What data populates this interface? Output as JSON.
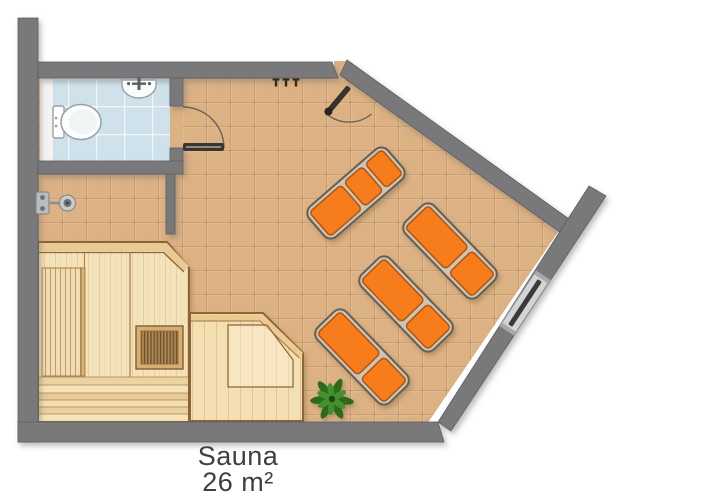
{
  "label": {
    "name": "Sauna",
    "area": "26 m²"
  },
  "palette": {
    "background": "#ffffff",
    "wall_gray": "#79797b",
    "floor_tile": "#dcb183",
    "bathroom_tile": "#cfe2ec",
    "wood_light": "#f2dfb5",
    "wood_frame": "#8d6537",
    "lounger_orange": "#f67c1e",
    "lounger_frame": "#cbc5b8",
    "plant_green": "#3c7d27",
    "text": "#3f3f3f"
  },
  "fixtures": {
    "loungers": 4,
    "toilet": 1,
    "sink": 1,
    "shower": 1,
    "sauna_heater": 1,
    "plant": 1,
    "window": 1,
    "doors": 2,
    "wall_hooks": 3
  }
}
